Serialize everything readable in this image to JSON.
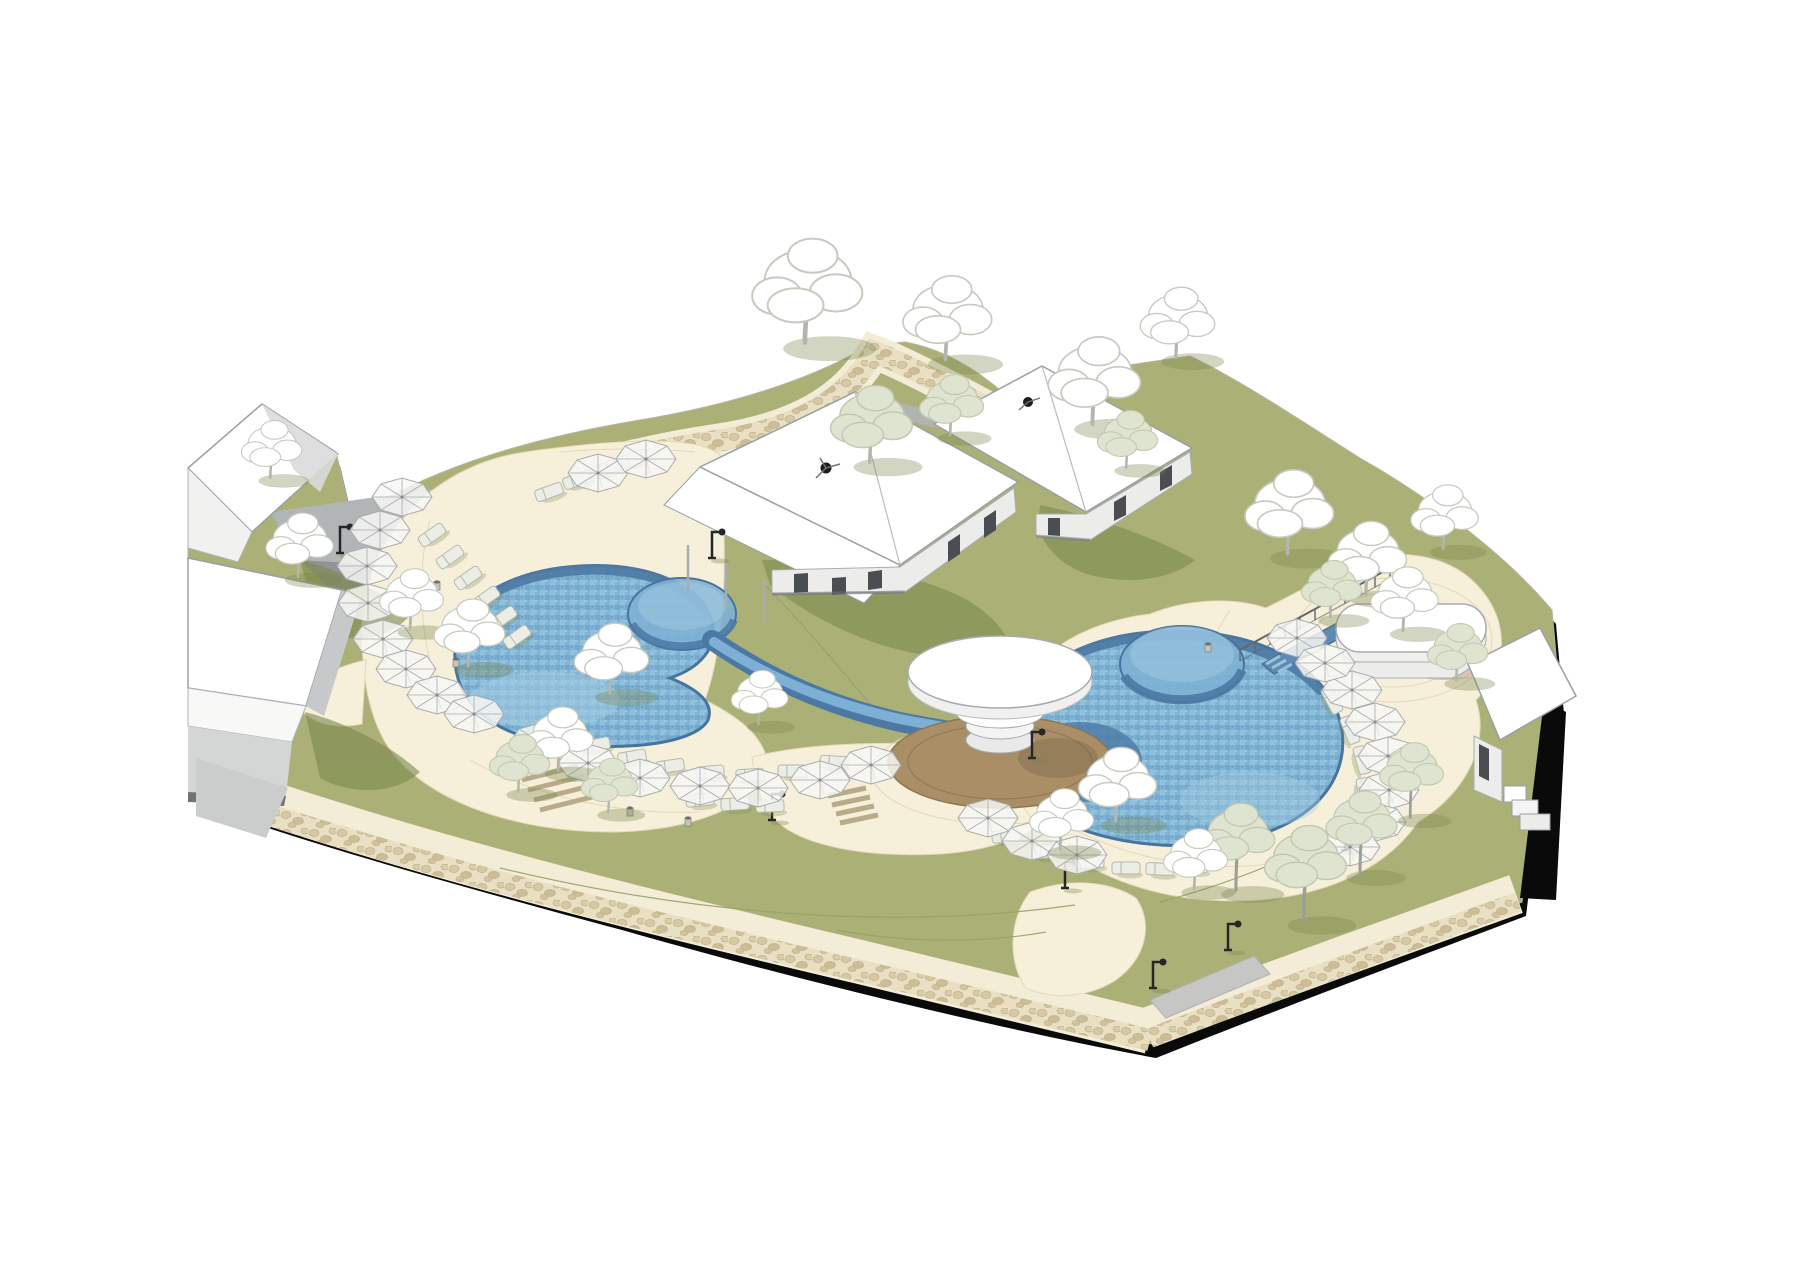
{
  "meta": {
    "kind": "axonometric-resort-pool-site-rendering",
    "has_text": false
  },
  "palette": {
    "bg": "#ffffff",
    "ink": "#0a0a0a",
    "plateEdge": "#b9b3a0",
    "grass": "#abb176",
    "grassShadow": "#7c884f",
    "grassLight": "#bcc188",
    "grassLine": "#96a168",
    "deck": "#f6efd9",
    "deckLine": "#e4d9b9",
    "pathCream": "#f3ecd6",
    "cobbleBase": "#e9dfc3",
    "cobbleStoneA": "#d6c8a5",
    "cobbleStoneB": "#cdbd97",
    "cobbleEdge": "#bfb08a",
    "water": "#7db0d4",
    "waterLight": "#a6cde2",
    "waterShadow": "#4c79a3",
    "waterDeep": "#44719b",
    "poolEdge": "#47749e",
    "white": "#ffffff",
    "roofLine": "#9aa0a5",
    "wallLight": "#ececeb",
    "wallMid": "#c6c8c9",
    "wallLine": "#a9adb0",
    "openingDark": "#4a4e52",
    "graySlope": "#b2b5b6",
    "graySlopeDark": "#8f9394",
    "concrete": "#c6c6c5",
    "wood": "#aa8f66",
    "woodShadow": "#8d7656",
    "treeWhite": "#ffffff",
    "treeOutline": "#c6cabf",
    "treeSage": "#dfe4d1",
    "treeSageOutline": "#c2c9b1",
    "trunk": "#b2b6ac",
    "trunkDark": "#9aa096",
    "umbrellaFill": "#f7f7f4",
    "umbrellaRib": "#a7abae",
    "loungerFill": "#eceee6",
    "loungerLine": "#b4b8ad",
    "lampBlack": "#262626",
    "railing": "#63686d",
    "stairTread": "#b9ab8a",
    "fanBlack": "#1c1c1c",
    "bollardFill": "#c2c6bd",
    "bollardLine": "#85897f"
  },
  "furniture": {
    "umbrellas": [
      [
        402,
        497
      ],
      [
        380,
        530
      ],
      [
        367,
        566
      ],
      [
        368,
        603
      ],
      [
        383,
        639
      ],
      [
        406,
        669
      ],
      [
        437,
        695
      ],
      [
        474,
        714
      ],
      [
        598,
        473
      ],
      [
        646,
        459
      ],
      [
        540,
        742
      ],
      [
        588,
        763
      ],
      [
        640,
        778
      ],
      [
        700,
        786
      ],
      [
        758,
        788
      ],
      [
        820,
        780
      ],
      [
        871,
        765
      ],
      [
        988,
        818
      ],
      [
        1032,
        841
      ],
      [
        1077,
        855
      ],
      [
        1352,
        690
      ],
      [
        1375,
        722
      ],
      [
        1388,
        756
      ],
      [
        1389,
        790
      ],
      [
        1376,
        822
      ],
      [
        1350,
        847
      ],
      [
        1297,
        638
      ],
      [
        1325,
        663
      ]
    ],
    "loungers": [
      [
        432,
        535,
        -35
      ],
      [
        450,
        557,
        -35
      ],
      [
        468,
        578,
        -35
      ],
      [
        486,
        598,
        -35
      ],
      [
        503,
        618,
        -35
      ],
      [
        517,
        637,
        -35
      ],
      [
        549,
        492,
        -20
      ],
      [
        577,
        480,
        -20
      ],
      [
        605,
        469,
        -20
      ],
      [
        633,
        459,
        -20
      ],
      [
        562,
        730,
        -12
      ],
      [
        596,
        745,
        -12
      ],
      [
        632,
        757,
        -10
      ],
      [
        670,
        766,
        -8
      ],
      [
        710,
        772,
        -6
      ],
      [
        750,
        775,
        -4
      ],
      [
        792,
        771,
        0
      ],
      [
        834,
        762,
        4
      ],
      [
        700,
        800,
        -6
      ],
      [
        735,
        804,
        -4
      ],
      [
        770,
        806,
        -2
      ],
      [
        1006,
        836,
        -6
      ],
      [
        1046,
        852,
        -4
      ],
      [
        1090,
        862,
        -2
      ],
      [
        1126,
        868,
        0
      ],
      [
        1160,
        869,
        2
      ],
      [
        1194,
        866,
        4
      ],
      [
        1332,
        700,
        62
      ],
      [
        1350,
        730,
        68
      ],
      [
        1362,
        760,
        74
      ],
      [
        1364,
        792,
        80
      ]
    ],
    "lamps": [
      [
        340,
        553
      ],
      [
        712,
        558
      ],
      [
        772,
        820
      ],
      [
        1032,
        758
      ],
      [
        1065,
        888
      ],
      [
        1153,
        988
      ],
      [
        1228,
        950
      ],
      [
        1345,
        850
      ]
    ],
    "bollards": [
      [
        437,
        590
      ],
      [
        443,
        640
      ],
      [
        456,
        667
      ],
      [
        630,
        816
      ],
      [
        688,
        826
      ],
      [
        1208,
        652
      ]
    ],
    "railing": {
      "x1": 1240,
      "y1": 650,
      "x2": 1390,
      "y2": 568,
      "posts": 10
    }
  },
  "vegetation": {
    "trees": [
      {
        "t": "w",
        "x": 808,
        "y": 296,
        "s": 1.55
      },
      {
        "t": "w",
        "x": 948,
        "y": 322,
        "s": 1.25
      },
      {
        "t": "s",
        "x": 872,
        "y": 428,
        "s": 1.15
      },
      {
        "t": "s",
        "x": 952,
        "y": 408,
        "s": 0.9
      },
      {
        "t": "w",
        "x": 1095,
        "y": 385,
        "s": 1.3
      },
      {
        "t": "w",
        "x": 1178,
        "y": 326,
        "s": 1.05
      },
      {
        "t": "s",
        "x": 1128,
        "y": 442,
        "s": 0.85
      },
      {
        "t": "w",
        "x": 272,
        "y": 452,
        "s": 0.85
      },
      {
        "t": "w",
        "x": 300,
        "y": 548,
        "s": 0.95
      },
      {
        "t": "w",
        "x": 412,
        "y": 602,
        "s": 0.9
      },
      {
        "t": "w",
        "x": 470,
        "y": 636,
        "s": 1.0
      },
      {
        "t": "w",
        "x": 612,
        "y": 662,
        "s": 1.05
      },
      {
        "t": "w",
        "x": 560,
        "y": 742,
        "s": 0.95
      },
      {
        "t": "s",
        "x": 520,
        "y": 766,
        "s": 0.85
      },
      {
        "t": "s",
        "x": 610,
        "y": 788,
        "s": 0.8
      },
      {
        "t": "w",
        "x": 760,
        "y": 700,
        "s": 0.8
      },
      {
        "t": "w",
        "x": 1290,
        "y": 516,
        "s": 1.25
      },
      {
        "t": "w",
        "x": 1368,
        "y": 562,
        "s": 1.1
      },
      {
        "t": "w",
        "x": 1445,
        "y": 520,
        "s": 0.95
      },
      {
        "t": "s",
        "x": 1332,
        "y": 592,
        "s": 0.85
      },
      {
        "t": "w",
        "x": 1405,
        "y": 602,
        "s": 0.95
      },
      {
        "t": "s",
        "x": 1458,
        "y": 655,
        "s": 0.85
      },
      {
        "t": "w",
        "x": 1118,
        "y": 788,
        "s": 1.1
      },
      {
        "t": "w",
        "x": 1062,
        "y": 822,
        "s": 0.9
      },
      {
        "t": "g",
        "x": 1238,
        "y": 842,
        "s": 1.05
      },
      {
        "t": "g",
        "x": 1306,
        "y": 868,
        "s": 1.15
      },
      {
        "t": "g",
        "x": 1362,
        "y": 828,
        "s": 1.0
      },
      {
        "t": "g",
        "x": 1412,
        "y": 776,
        "s": 0.9
      },
      {
        "t": "w",
        "x": 1196,
        "y": 862,
        "s": 0.9
      }
    ]
  }
}
